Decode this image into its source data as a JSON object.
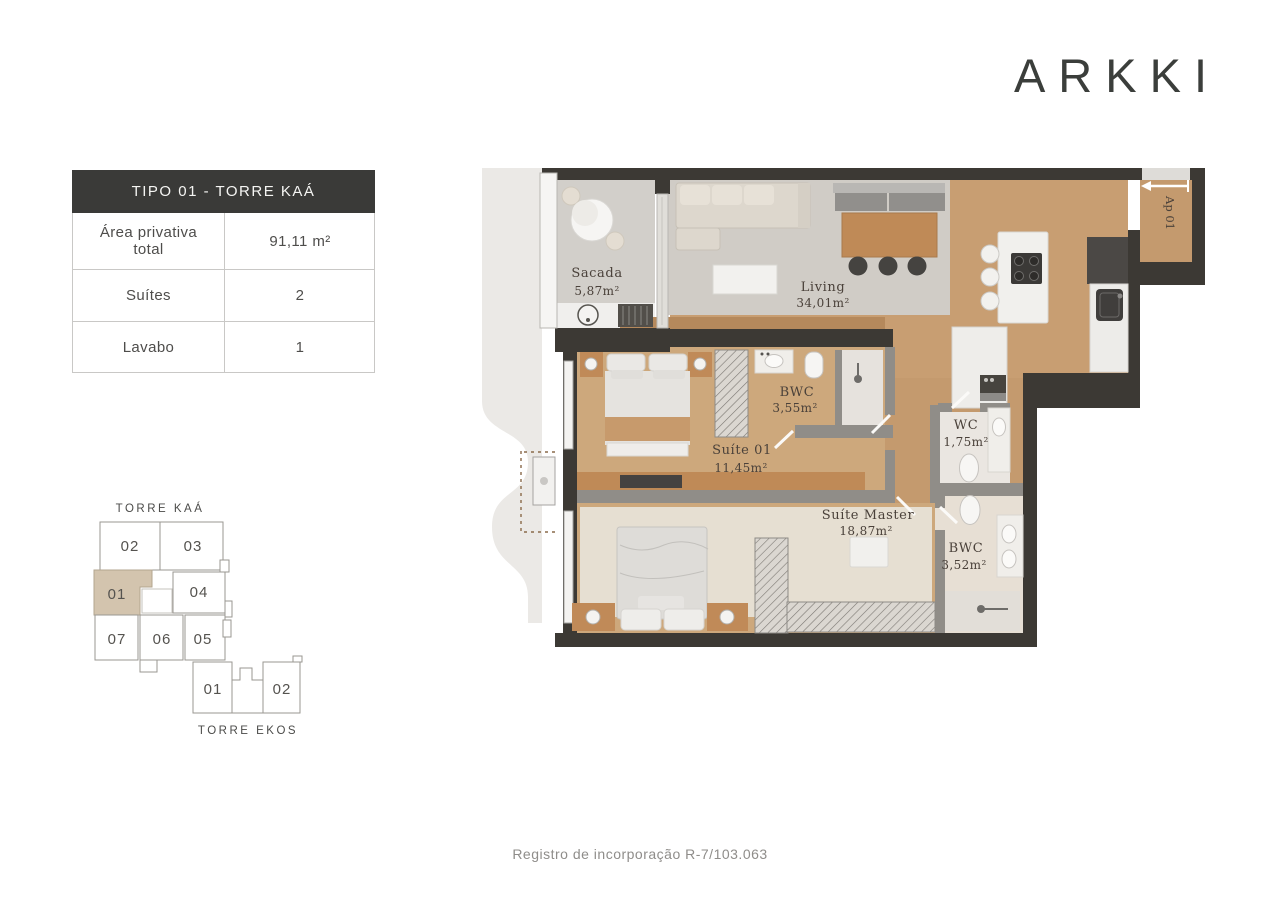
{
  "logo": {
    "text": "ARKKI"
  },
  "info_table": {
    "header": "TIPO 01 - TORRE KAÁ",
    "rows": [
      {
        "label": "Área privativa total",
        "value": "91,11 m²"
      },
      {
        "label": "Suítes",
        "value": "2"
      },
      {
        "label": "Lavabo",
        "value": "1"
      }
    ]
  },
  "keyplan": {
    "torre_kaa_label": "TORRE KAÁ",
    "torre_ekos_label": "TORRE EKOS",
    "highlight_color": "#d3c4ae",
    "kaa_units": [
      {
        "number": "02",
        "highlighted": false
      },
      {
        "number": "03",
        "highlighted": false
      },
      {
        "number": "01",
        "highlighted": true
      },
      {
        "number": "04",
        "highlighted": false
      },
      {
        "number": "07",
        "highlighted": false
      },
      {
        "number": "06",
        "highlighted": false
      },
      {
        "number": "05",
        "highlighted": false
      }
    ],
    "ekos_units": [
      {
        "number": "01"
      },
      {
        "number": "02"
      }
    ]
  },
  "floorplan": {
    "unit_label": "Ap 01",
    "entry_arrow_direction": "left",
    "rooms": [
      {
        "name": "Sacada",
        "area": "5,87m²"
      },
      {
        "name": "Living",
        "area": "34,01m²"
      },
      {
        "name": "BWC",
        "area": "3,55m²"
      },
      {
        "name": "Suíte 01",
        "area": "11,45m²"
      },
      {
        "name": "WC",
        "area": "1,75m²"
      },
      {
        "name": "Suíte Master",
        "area": "18,87m²"
      },
      {
        "name": "BWC",
        "area": "3,52m²"
      }
    ],
    "colors": {
      "wall_dark": "#3c3934",
      "wall_gray": "#908d88",
      "floor_wood": "#c89e72",
      "floor_bedroom": "#cda87c",
      "rug_gray": "#d0ccc6",
      "rug_master": "#e6dfd2",
      "backdrop": "#ebe9e6"
    }
  },
  "footer": {
    "registro": "Registro de incorporação R-7/103.063"
  }
}
